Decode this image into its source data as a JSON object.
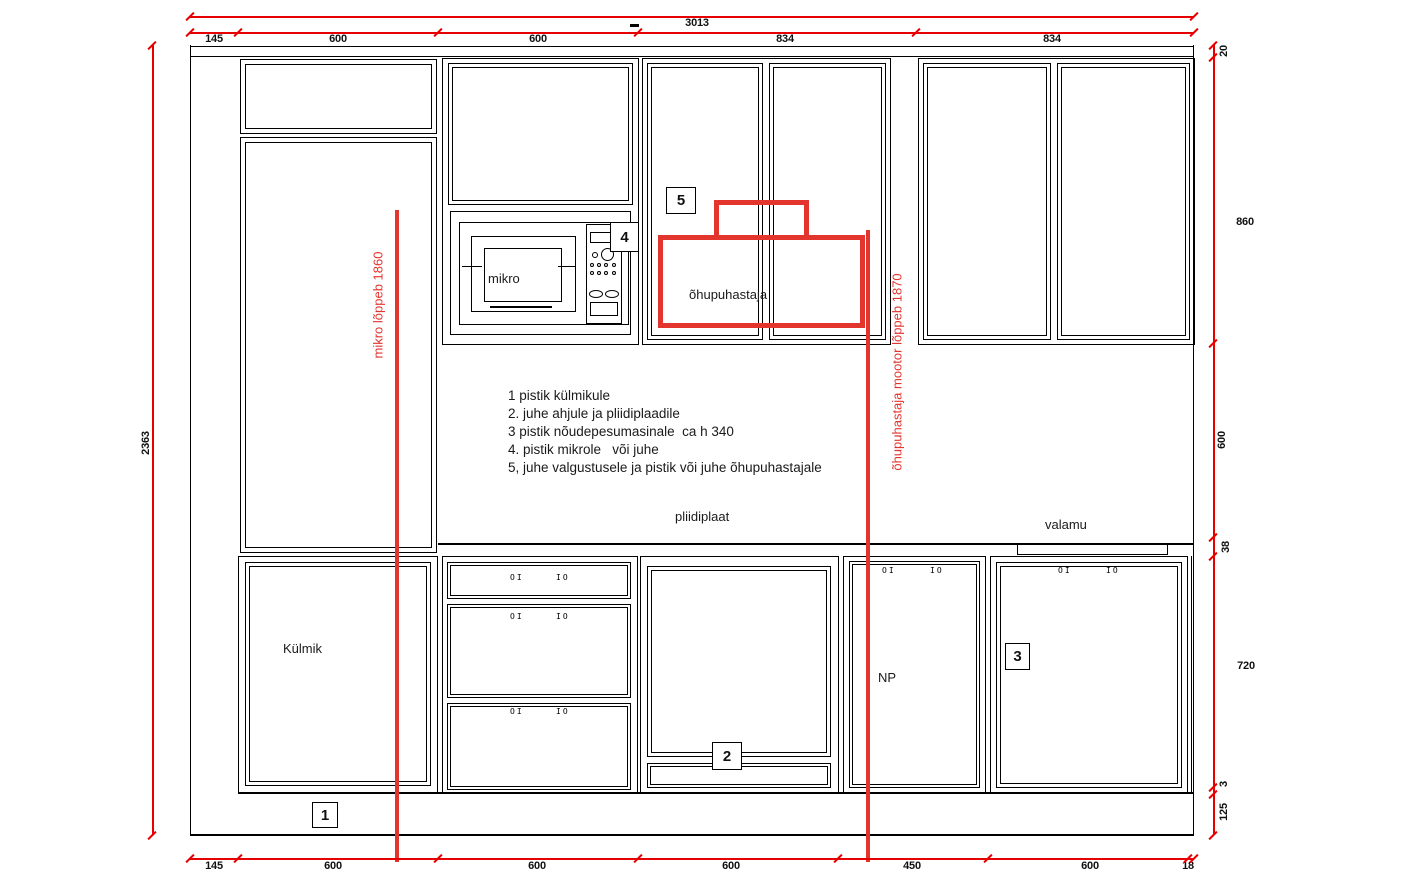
{
  "colors": {
    "dimension_red": "#e60000",
    "marker_red": "#e2352e",
    "line_black": "#000000",
    "background": "#ffffff"
  },
  "dimensions": {
    "top_total": "3013",
    "top_row": [
      "145",
      "600",
      "600",
      "834",
      "834"
    ],
    "bottom_row": [
      "145",
      "600",
      "600",
      "600",
      "450",
      "600",
      "18"
    ],
    "left_total": "2363",
    "right_column": [
      "20",
      "860",
      "600",
      "38",
      "720",
      "3",
      "125"
    ]
  },
  "markers": {
    "mikro_line_label": "mikro lõppeb 1860",
    "hood_line_label": "õhupuhastaja mootor lõppeb  1870",
    "hood_box_label": "õhupuhastaja"
  },
  "labels": {
    "mikro": "mikro",
    "pliidiplaat": "pliidiplaat",
    "valamu": "valamu",
    "kylmik": "Külmik",
    "np": "NP"
  },
  "callouts": [
    "1",
    "2",
    "3",
    "4",
    "5"
  ],
  "notes": [
    "1 pistik külmikule",
    "2. juhe ahjule ja pliidiplaadile",
    "3 pistik nõudepesumasinale  ca h 340",
    "4. pistik mikrole   või juhe",
    "5, juhe valgustusele ja pistik või juhe õhupuhastajale"
  ],
  "drawer_symbols": {
    "left": "OI",
    "right": "IO"
  }
}
